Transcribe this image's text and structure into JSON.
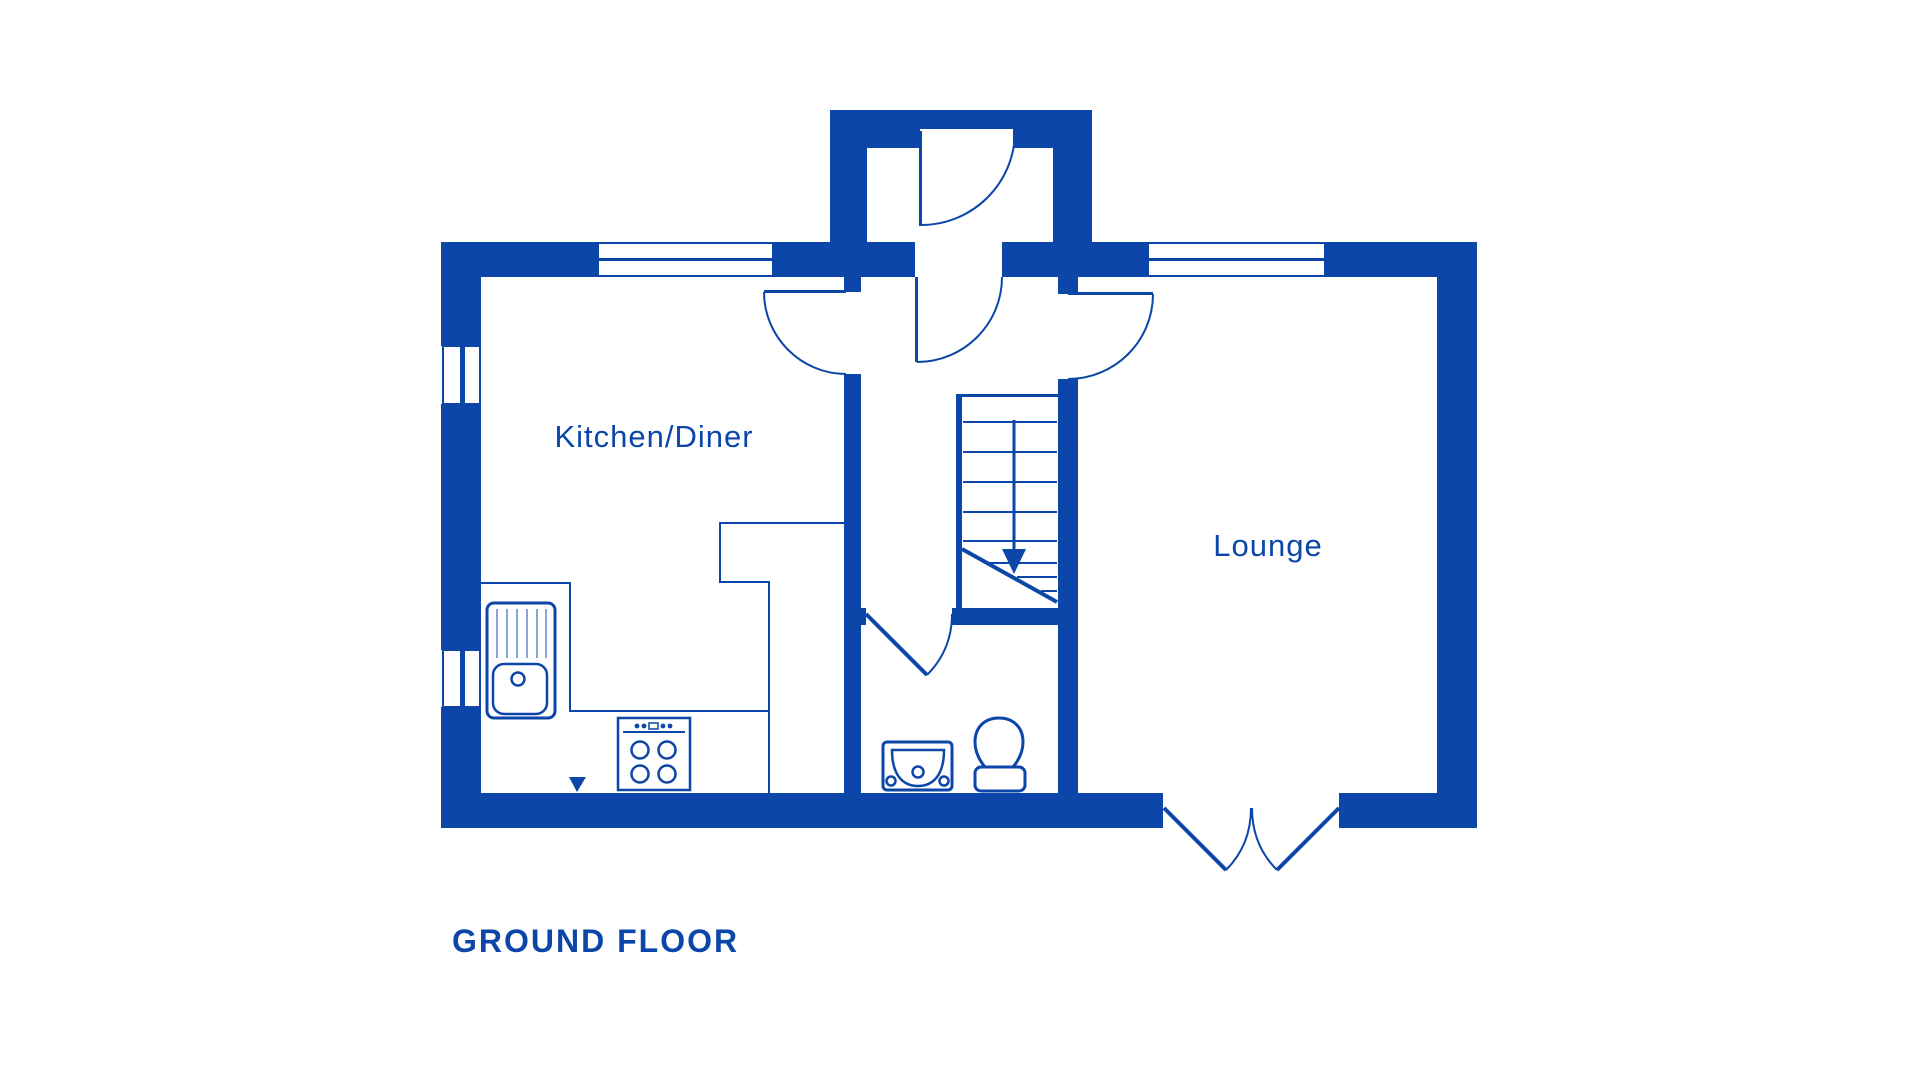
{
  "plan": {
    "floor_label": "GROUND FLOOR",
    "rooms": {
      "kitchen": {
        "label": "Kitchen/Diner"
      },
      "lounge": {
        "label": "Lounge"
      }
    }
  },
  "icons": {
    "stairs_direction": "down-arrow-icon",
    "kitchen_sink": "kitchen-sink-with-drainer-icon",
    "stove": "four-burner-stove-icon",
    "toilet": "toilet-icon",
    "basin": "hand-basin-icon",
    "kitchen_marker": "triangle-down-marker"
  },
  "colors": {
    "plan_blue": "#0b46a8",
    "pane_blue": "#6286cc",
    "background": "#ffffff"
  }
}
